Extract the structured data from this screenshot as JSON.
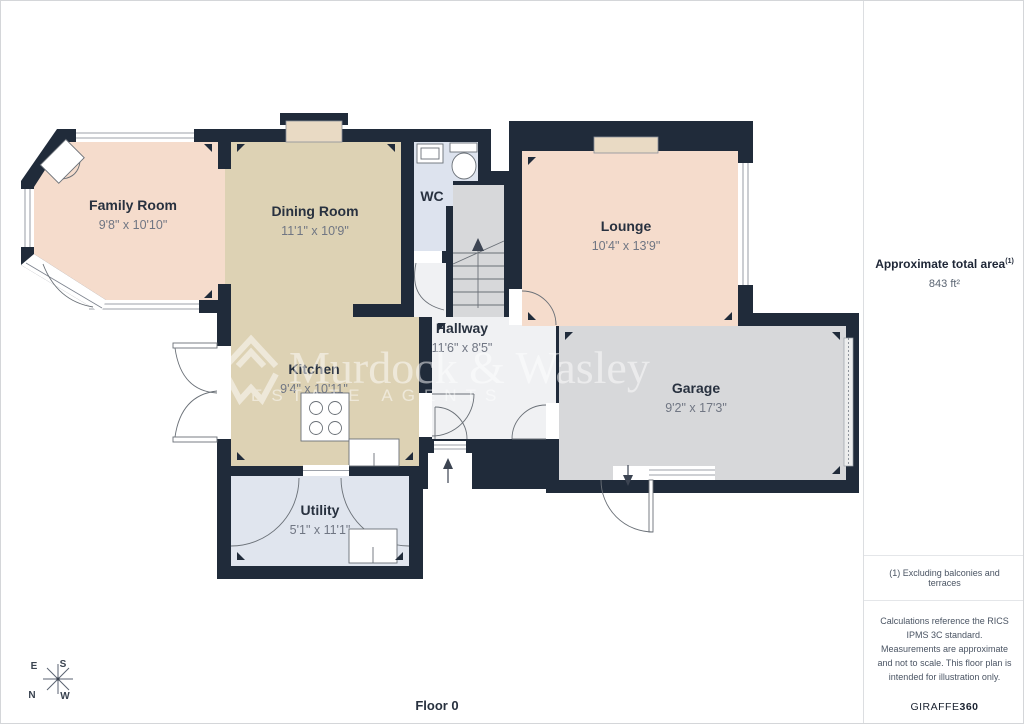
{
  "watermark": {
    "line1": "Murdock & Wasley",
    "line2": "ESTATE AGENTS"
  },
  "floor_label": "Floor 0",
  "compass": {
    "e": "E",
    "s": "S",
    "n": "N",
    "w": "W"
  },
  "rooms": {
    "family_room": {
      "name": "Family Room",
      "dims": "9'8\" x 10'10\""
    },
    "dining_room": {
      "name": "Dining Room",
      "dims": "11'1\" x 10'9\""
    },
    "wc": {
      "name": "WC"
    },
    "lounge": {
      "name": "Lounge",
      "dims": "10'4\" x 13'9\""
    },
    "hallway": {
      "name": "Hallway",
      "dims": "11'6\" x 8'5\""
    },
    "kitchen": {
      "name": "Kitchen",
      "dims": "9'4\" x 10'11\""
    },
    "garage": {
      "name": "Garage",
      "dims": "9'2\" x 17'3\""
    },
    "utility": {
      "name": "Utility",
      "dims": "5'1\" x 11'1\""
    }
  },
  "sidebar": {
    "total_area_label": "Approximate total area",
    "total_area_note_ref": "(1)",
    "total_area_value": "843 ft²",
    "footnote": "(1) Excluding balconies and terraces",
    "disclaimer": "Calculations reference the RICS IPMS 3C standard. Measurements are approximate and not to scale. This floor plan is intended for illustration only.",
    "brand_name": "GIRAFFE",
    "brand_suffix": "360"
  },
  "colors": {
    "wall": "#202b3a",
    "family_floor": "#f5dccc",
    "dining_kitchen_floor": "#ddd2b4",
    "wc_floor": "#dde3ee",
    "hallway_floor": "#f0f1f3",
    "garage_floor": "#d7d8da",
    "utility_floor": "#e0e5ee",
    "sill": "#e9dac4"
  }
}
